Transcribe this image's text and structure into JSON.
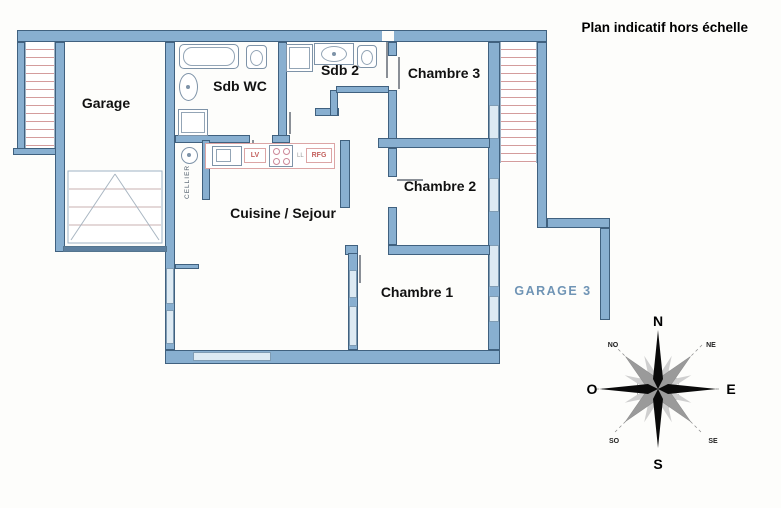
{
  "title": "Plan indicatif hors échelle",
  "rooms": {
    "garage": "Garage",
    "sdb_wc": "Sdb WC",
    "sdb_2": "Sdb 2",
    "chambre_3": "Chambre 3",
    "chambre_2": "Chambre 2",
    "chambre_1": "Chambre 1",
    "cuisine_sejour": "Cuisine / Sejour",
    "cellier": "CELLIER",
    "garage_3": "GARAGE 3"
  },
  "kitchen": {
    "dishwasher": "LV",
    "washer": "LL",
    "fridge": "RFG"
  },
  "compass": {
    "n": "N",
    "s": "S",
    "e": "E",
    "o": "O",
    "ne": "NE",
    "no": "NO",
    "se": "SE",
    "so": "SO"
  },
  "colors": {
    "wall": "#88afd0",
    "wall_border": "#40617f",
    "hatch_line": "#d49c9c",
    "kitchen_red": "#c4625f",
    "garage3_text": "#6f94b5"
  }
}
